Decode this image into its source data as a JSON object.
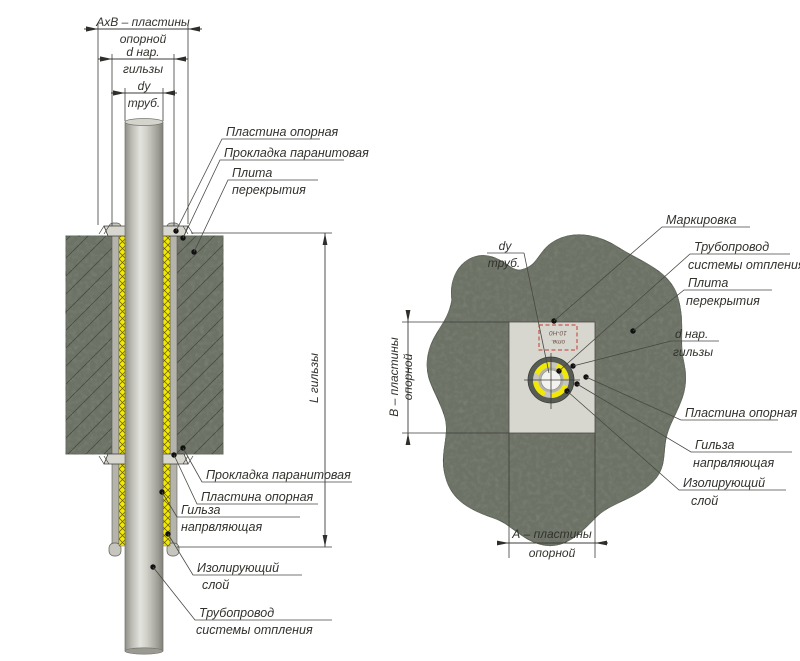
{
  "section": {
    "dims": {
      "axb_l1": "АхВ – пластины",
      "axb_l2": "опорной",
      "dnar_l1": "d нар.",
      "dnar_l2": "гильзы",
      "du_l1": "dу",
      "du_l2": "труб.",
      "length": "L гильзы"
    },
    "labels": {
      "plastina_top": "Пластина опорная",
      "prokladka_top": "Прокладка паранитовая",
      "plita_l1": "Плита",
      "plita_l2": "перекрытия",
      "prokladka_bottom": "Прокладка паранитовая",
      "plastina_bottom": "Пластина опорная",
      "gilza_l1": "Гильза",
      "gilza_l2": "напрвляющая",
      "izol_l1": "Изолирующий",
      "izol_l2": "слой",
      "truba_l1": "Трубопровод",
      "truba_l2": "системы отпления"
    }
  },
  "plan": {
    "dims": {
      "b_l1": "В – пластины",
      "b_l2": "опорной",
      "a_l1": "А – пластины",
      "a_l2": "опорной"
    },
    "labels": {
      "markirovka": "Маркировка",
      "du_l1": "dу",
      "du_l2": "труб.",
      "truba_l1": "Трубопровод",
      "truba_l2": "системы отпления",
      "plita_l1": "Плита",
      "plita_l2": "перекрытия",
      "dnar_l1": "d нар.",
      "dnar_l2": "гильзы",
      "plastina": "Пластина опорная",
      "gilza_l1": "Гильза",
      "gilza_l2": "напрвляющая",
      "izol_l1": "Изолирующий",
      "izol_l2": "слой",
      "marking_l1": "отв.",
      "marking_l2": "10-Н0"
    }
  },
  "colors": {
    "concrete": "#7b8076",
    "insulation": "#f2e806",
    "pipe_mid": "#d9d9d3",
    "plate": "#d8d7cf",
    "sleeve": "#b4b4ac",
    "marking_red": "#c23b2e",
    "ink": "#32322d"
  }
}
